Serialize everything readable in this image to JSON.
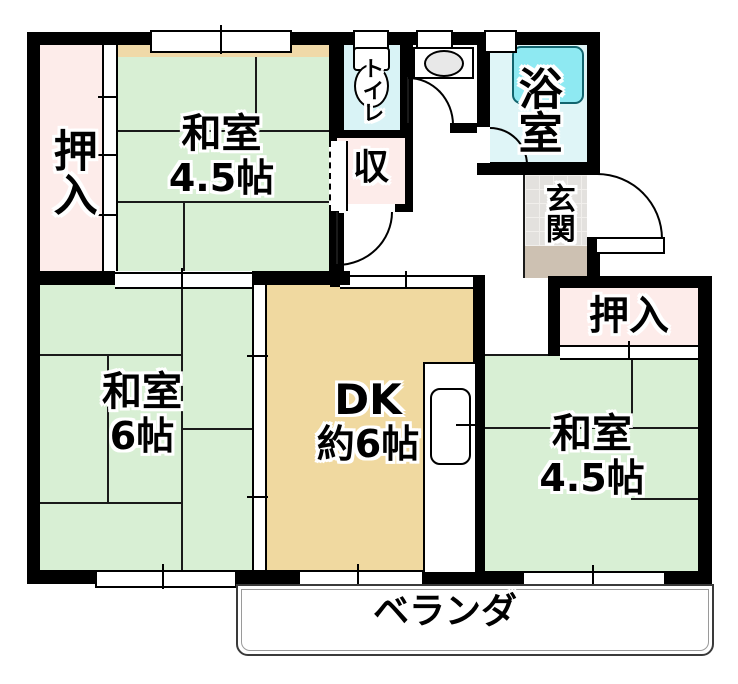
{
  "rooms": {
    "oshiire_left": {
      "label": "押入"
    },
    "washitsu_top": {
      "label": "和室",
      "size": "4.5帖"
    },
    "toilet": {
      "label": "トイレ"
    },
    "storage": {
      "label": "収"
    },
    "bathroom": {
      "label": "浴室"
    },
    "genkan": {
      "label": "玄関"
    },
    "oshiire_right": {
      "label": "押入"
    },
    "washitsu_left": {
      "label": "和室",
      "size": "6帖"
    },
    "dk": {
      "label": "DK",
      "size": "約6帖"
    },
    "washitsu_right": {
      "label": "和室",
      "size": "4.5帖"
    },
    "veranda": {
      "label": "ベランダ"
    }
  },
  "colors": {
    "tatami_green": "#d8efd4",
    "closet_pink": "#fdecea",
    "dk_tan": "#f0d9a0",
    "toilet_cyan": "#d9f3f6",
    "bath_cyan": "#dff5f7",
    "bathtub_cyan": "#8ee9f2",
    "genkan_tile_gray": "#e3e1de",
    "genkan_step_tan": "#cdc1b2",
    "wall_black": "#000000"
  }
}
